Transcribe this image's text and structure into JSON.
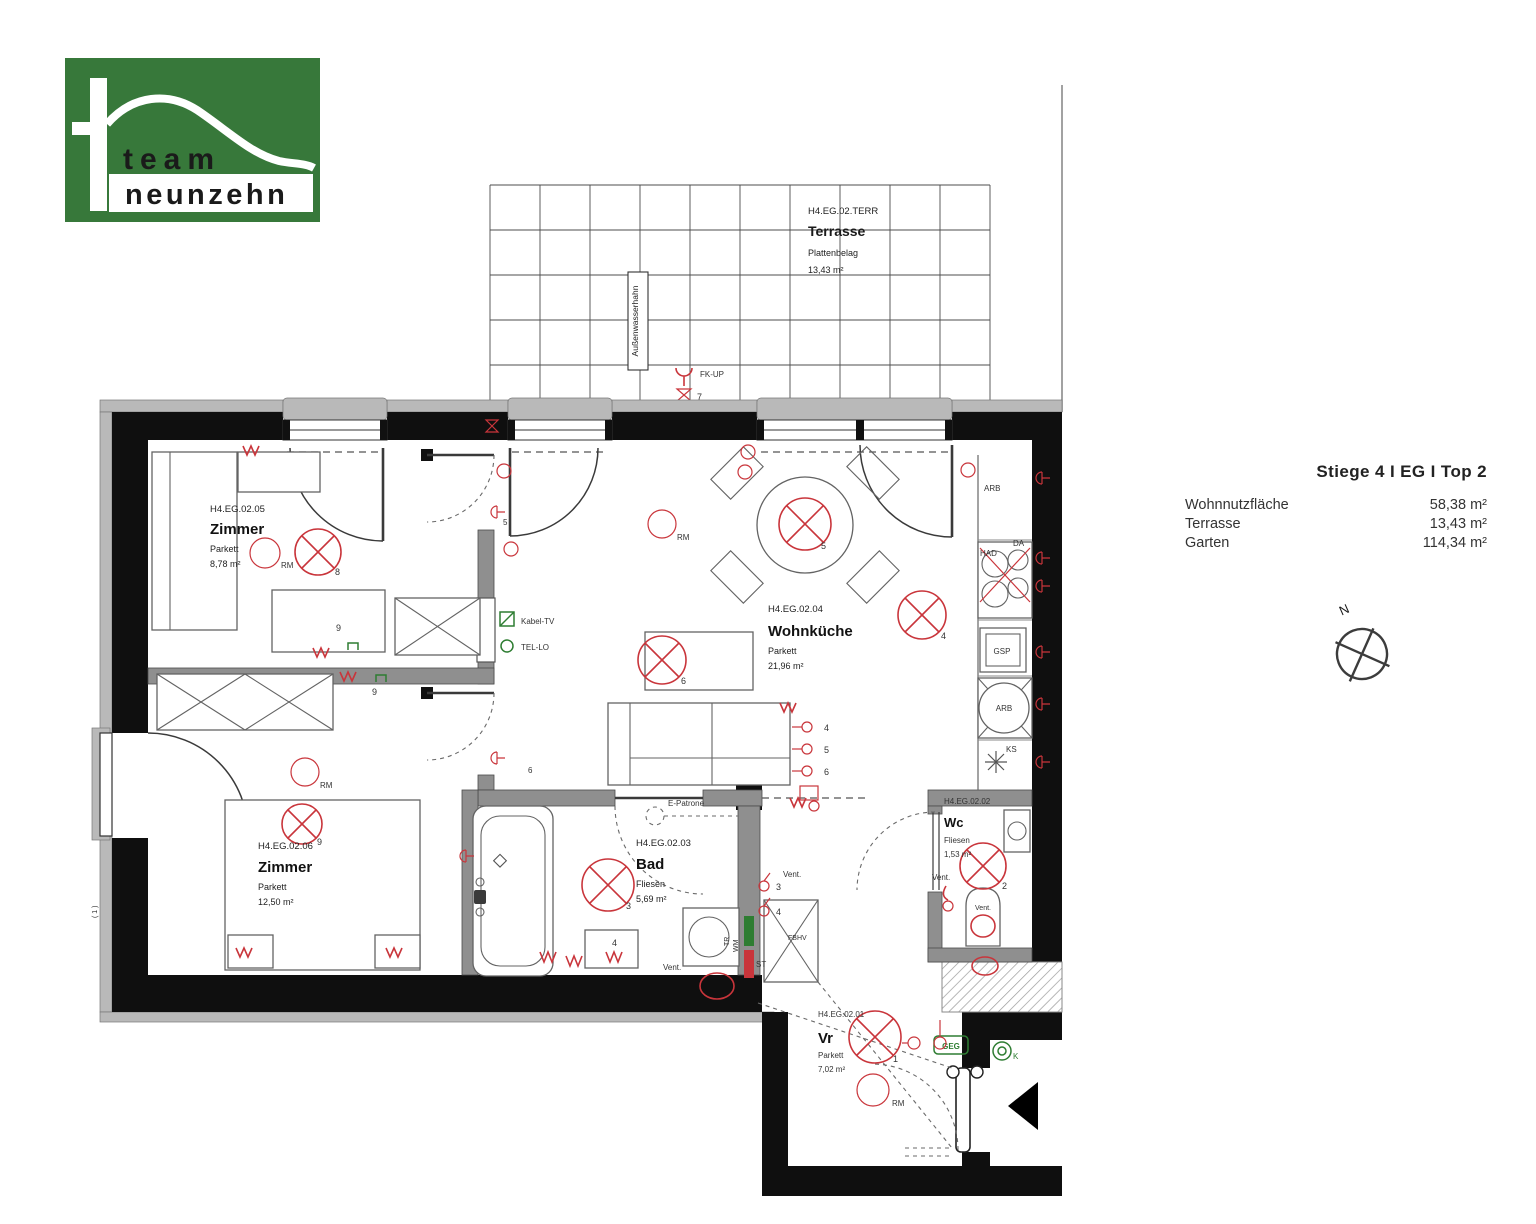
{
  "logo": {
    "line1": "team",
    "line2": "neunzehn",
    "green": "#37783a"
  },
  "info_panel": {
    "title": "Stiege 4 I  EG  I  Top 2",
    "rows": [
      {
        "label": "Wohnnutzfläche",
        "value": "58,38 m²"
      },
      {
        "label": "Terrasse",
        "value": "13,43 m²"
      },
      {
        "label": "Garten",
        "value": "114,34 m²"
      }
    ],
    "compass_n": "N"
  },
  "terrace": {
    "code": "H4.EG.02.TERR",
    "name": "Terrasse",
    "floor": "Plattenbelag",
    "area": "13,43 m²",
    "tap_label": "Außenwasserhahn",
    "fk_label": "FK-UP"
  },
  "rooms": {
    "zimmer1": {
      "code": "H4.EG.02.05",
      "name": "Zimmer",
      "floor": "Parkett",
      "area": "8,78 m²"
    },
    "zimmer2": {
      "code": "H4.EG.02.06",
      "name": "Zimmer",
      "floor": "Parkett",
      "area": "12,50 m²"
    },
    "wohnkueche": {
      "code": "H4.EG.02.04",
      "name": "Wohnküche",
      "floor": "Parkett",
      "area": "21,96 m²"
    },
    "bad": {
      "code": "H4.EG.02.03",
      "name": "Bad",
      "floor": "Fliesen",
      "area": "5,69 m²"
    },
    "wc": {
      "code": "H4.EG.02.02",
      "name": "Wc",
      "floor": "Fliesen",
      "area": "1,53 m²"
    },
    "vr": {
      "code": "H4.EG.02.01",
      "name": "Vr",
      "floor": "Parkett",
      "area": "7,02 m²"
    }
  },
  "kitchen": {
    "arb1": "ARB",
    "had": "HAD",
    "da": "DA",
    "gsp": "GSP",
    "arb2": "ARB",
    "ks": "KS"
  },
  "electro": {
    "kabel_tv": "Kabel-TV",
    "tel_lo": "TEL-LO",
    "e_patrone": "E-Patrone",
    "geg": "GEG",
    "k": "K",
    "st": "ST",
    "fbhv": "FBHV",
    "wm": "WM",
    "tr": "TR",
    "vent": "Vent.",
    "rm": "RM"
  },
  "numbers": {
    "n1": "1",
    "n2": "2",
    "n3": "3",
    "n4": "4",
    "n5": "5",
    "n6": "6",
    "n7": "7",
    "n8": "8",
    "n9": "9"
  },
  "misc": {
    "note": "( 1 )"
  }
}
